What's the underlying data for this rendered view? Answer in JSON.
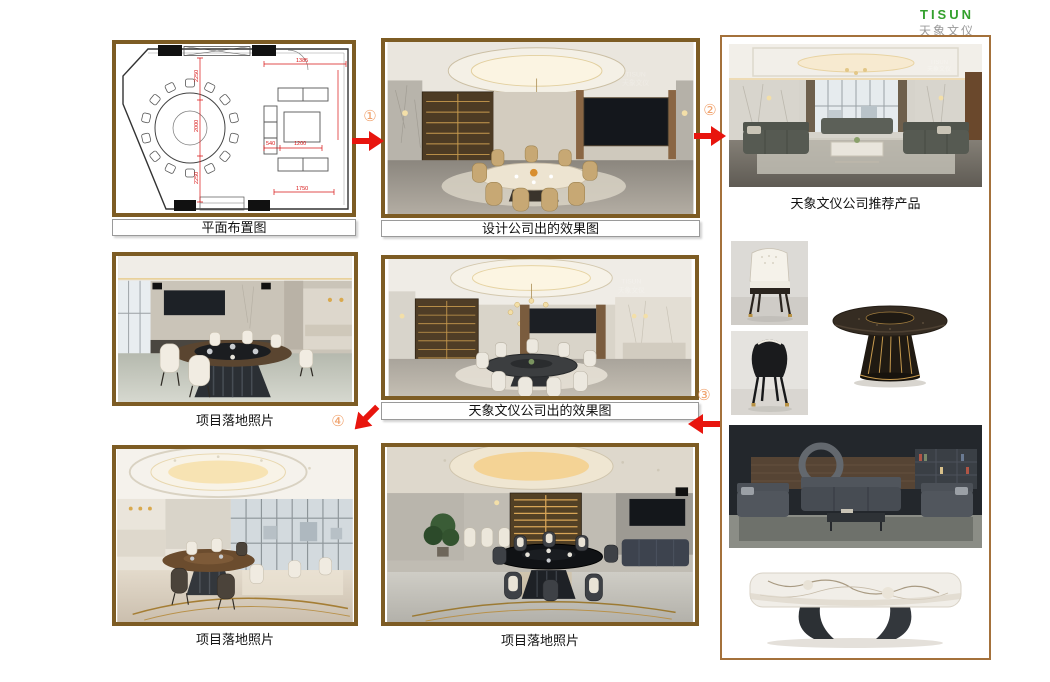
{
  "logo": {
    "brand": "TISUN",
    "brand_cn": "天象文仪"
  },
  "floor_plan": {
    "label": "平面布置图",
    "dims": {
      "v_top": "2250",
      "v_mid": "2000",
      "v_bot": "2250",
      "top": "1385",
      "sofa_a": "540",
      "sofa_b": "1200",
      "bottom": "1750"
    }
  },
  "design_render": {
    "label": "设计公司出的效果图"
  },
  "tisun_products": {
    "label": "天象文仪公司推荐产品"
  },
  "tisun_render": {
    "label": "天象文仪公司出的效果图"
  },
  "site_photos": {
    "label_mid": "项目落地照片",
    "label_bottom_left": "项目落地照片",
    "label_bottom_mid": "项目落地照片"
  },
  "flow": {
    "steps": [
      "①",
      "②",
      "③",
      "④"
    ]
  },
  "colors": {
    "frame_brown": "#7d5c24",
    "panel_border": "#a4713b",
    "arrow_red": "#e8150e",
    "step_orange": "#f0a36e",
    "logo_green": "#33a02c",
    "logo_gray": "#9a9a9a"
  }
}
